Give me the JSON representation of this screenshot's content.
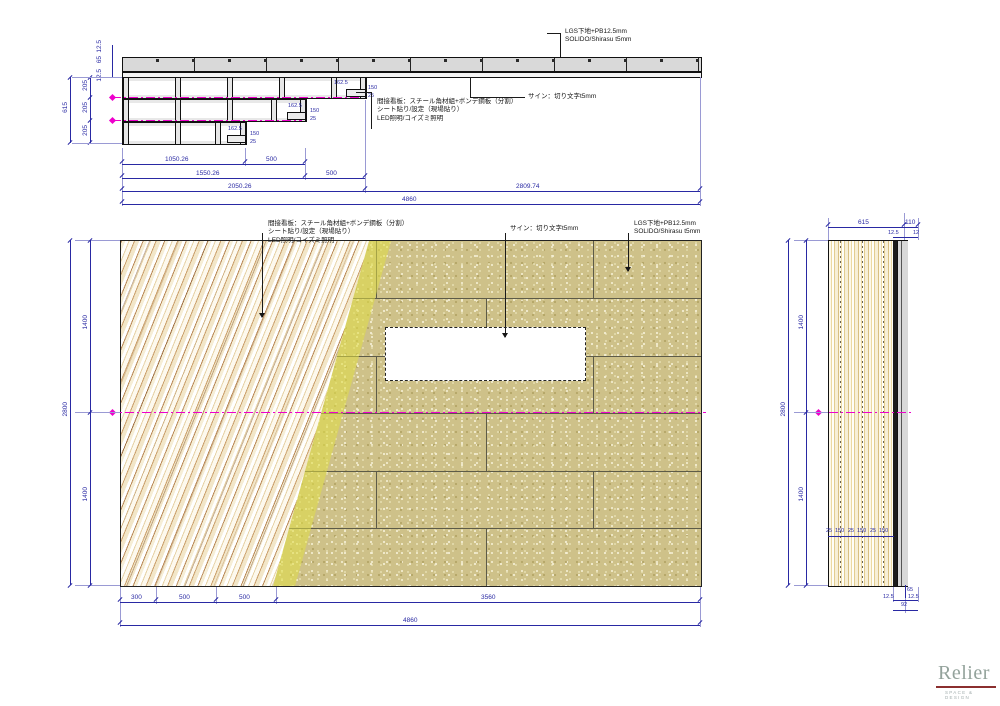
{
  "annotations": {
    "lgs_note": [
      "LGS下地+PB12.5mm",
      "SOLIDO/Shirasu t5mm"
    ],
    "sign_note": "サイン：切り文字t5mm",
    "kanban_note": [
      "間接看板：スチール角材組+ボンデ鋼板（分割）",
      "シート貼り/設定（現場貼り）",
      "LED照明/コイズミ照明"
    ]
  },
  "top_view": {
    "thickness_dims": [
      "12.5",
      "65",
      "12.5"
    ],
    "row_dims": [
      "205",
      "205",
      "205"
    ],
    "height_total": "615",
    "step1": {
      "w": "162.5",
      "h": "150",
      "o": "25"
    },
    "step2": {
      "w": "162.5",
      "h": "150",
      "o": "25"
    },
    "step3": {
      "w": "162.5",
      "h": "150",
      "o": "25"
    },
    "dim_rows": {
      "r1": [
        "1050.26",
        "500"
      ],
      "r2": [
        "1550.26",
        "500"
      ],
      "r3": [
        "2050.26",
        "2809.74"
      ],
      "total": "4860"
    }
  },
  "elevation": {
    "left_dims": [
      "1400",
      "1400"
    ],
    "left_total": "2800",
    "bottom_dims": [
      "300",
      "500",
      "500",
      "3560"
    ],
    "bottom_total": "4860"
  },
  "side_view": {
    "top_dims": [
      "615",
      "110"
    ],
    "top_small_dims": [
      "12.5",
      "12"
    ],
    "left_dims": [
      "1400",
      "1400"
    ],
    "left_total": "2800",
    "strip_chain": [
      "25",
      "150",
      "25",
      "150",
      "25",
      "150"
    ],
    "bottom_small_dims": [
      "65",
      "12.5",
      "12.5",
      "92"
    ]
  },
  "logo": {
    "name": "Relier",
    "tagline": "SPACE & DESIGN"
  }
}
